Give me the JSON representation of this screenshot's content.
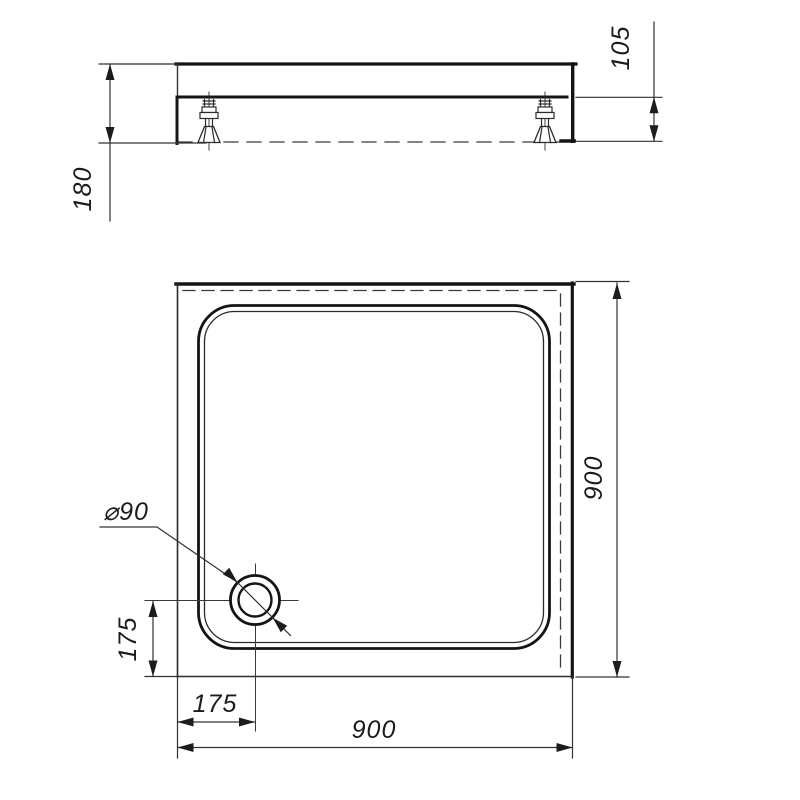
{
  "dimensions": {
    "side_total_height": "180",
    "side_leg_height": "105",
    "plan_width_bottom": "900",
    "plan_depth_right": "900",
    "drain_diameter": "⌀90",
    "drain_offset_horizontal": "175",
    "drain_offset_vertical": "175"
  }
}
